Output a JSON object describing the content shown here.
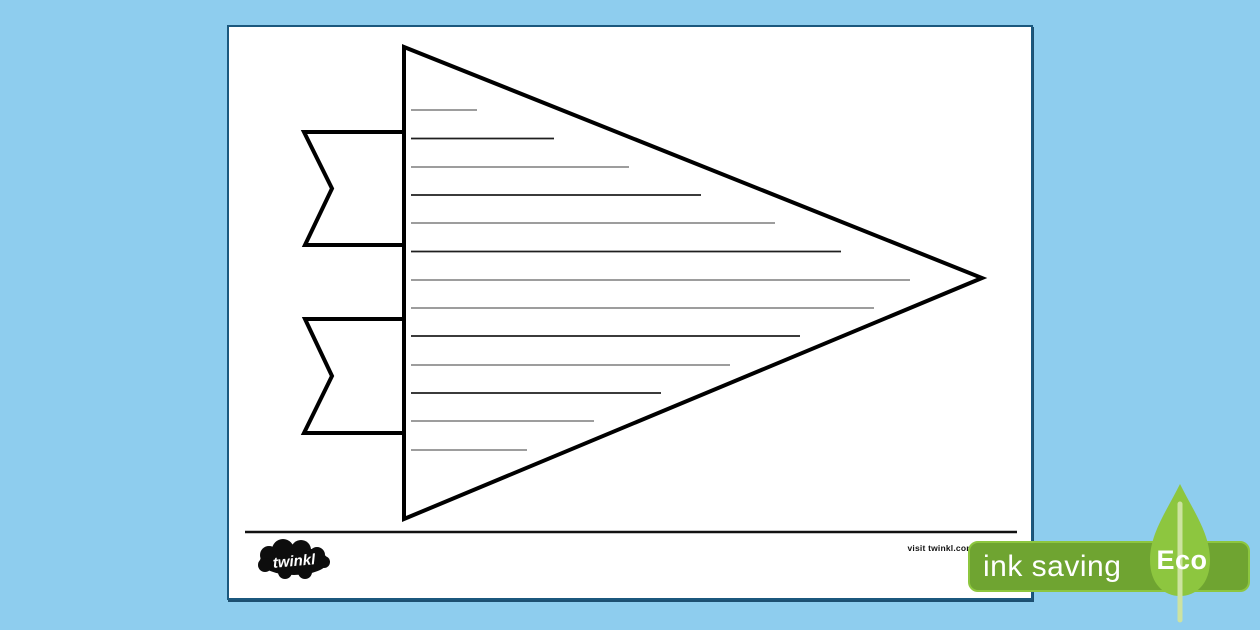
{
  "colors": {
    "bg": "#8ecdee",
    "paper": "#ffffff",
    "paper-border": "#1b587e",
    "line-dark": "#1f1f1f",
    "line-light": "#8f8f8f",
    "badge": "#6fa431",
    "badge-border": "#8dc63f",
    "leaf": "#8dc63f",
    "stem": "#cde3a0",
    "badge-text": "#ffffff"
  },
  "footer": {
    "logo_text": "twinkl",
    "visit_text": "visit twinkl.com"
  },
  "badge": {
    "ink_saving_label": "ink saving",
    "eco_label": "Eco"
  },
  "worksheet": {
    "writing_lines": [
      {
        "x1": 182,
        "x2": 248,
        "y": 83,
        "shade": "light"
      },
      {
        "x1": 182,
        "x2": 325,
        "y": 111.5,
        "shade": "dark"
      },
      {
        "x1": 182,
        "x2": 400,
        "y": 140,
        "shade": "light"
      },
      {
        "x1": 182,
        "x2": 472,
        "y": 168,
        "shade": "dark"
      },
      {
        "x1": 182,
        "x2": 546,
        "y": 196,
        "shade": "light"
      },
      {
        "x1": 182,
        "x2": 612,
        "y": 224.5,
        "shade": "dark"
      },
      {
        "x1": 182,
        "x2": 681,
        "y": 253,
        "shade": "light"
      },
      {
        "x1": 182,
        "x2": 645,
        "y": 281,
        "shade": "light"
      },
      {
        "x1": 182,
        "x2": 571,
        "y": 309,
        "shade": "dark"
      },
      {
        "x1": 182,
        "x2": 501,
        "y": 338,
        "shade": "light"
      },
      {
        "x1": 182,
        "x2": 432,
        "y": 366,
        "shade": "dark"
      },
      {
        "x1": 182,
        "x2": 365,
        "y": 394,
        "shade": "light"
      },
      {
        "x1": 182,
        "x2": 298,
        "y": 423,
        "shade": "light"
      }
    ]
  }
}
